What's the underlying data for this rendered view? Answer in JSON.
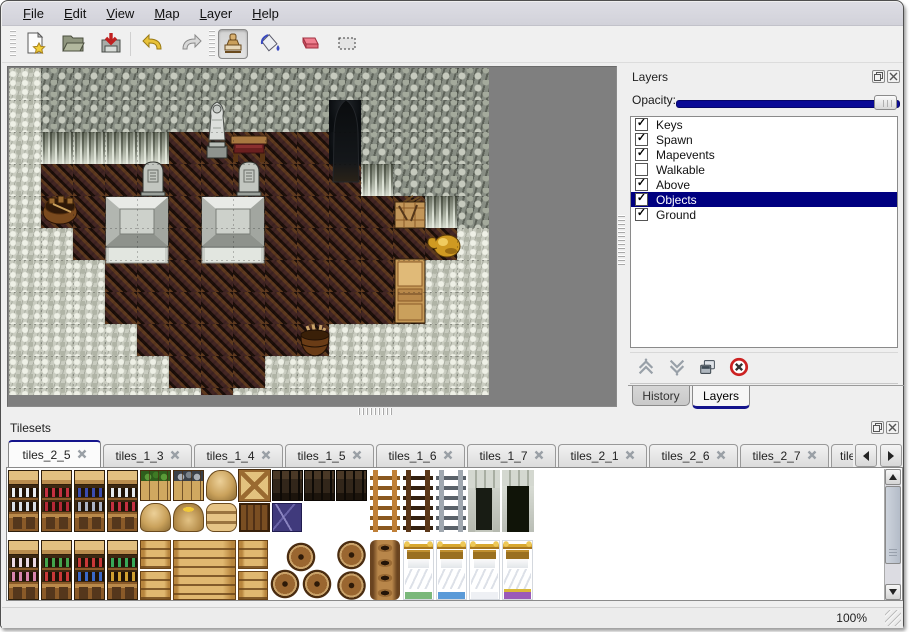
{
  "window": {
    "menu": [
      {
        "label": "File"
      },
      {
        "label": "Edit"
      },
      {
        "label": "View"
      },
      {
        "label": "Map"
      },
      {
        "label": "Layer"
      },
      {
        "label": "Help"
      }
    ],
    "toolbar": {
      "buttons": [
        {
          "icon": "new-file-icon"
        },
        {
          "icon": "open-icon"
        },
        {
          "icon": "save-icon"
        },
        {
          "icon": "undo-icon"
        },
        {
          "icon": "redo-icon"
        },
        {
          "icon": "stamp-tool-icon",
          "active": true
        },
        {
          "icon": "fill-tool-icon"
        },
        {
          "icon": "eraser-tool-icon"
        },
        {
          "icon": "select-tool-icon"
        }
      ]
    },
    "status": {
      "zoom_level": "100%"
    }
  },
  "map_view": {
    "tile_size": 32,
    "legend": {
      "W": "stone-wall",
      "C": "cliff-wall",
      "R": "stone-ground",
      "F": "wood-floor",
      "D": "cave-entrance"
    },
    "rows": [
      "RWWWWWWWWWWWWWW",
      "RWWWWWWWWWDWWWW",
      "RCCCCFFFFFDWWWW",
      "RFFFFFFFFFFCWWW",
      "RFFFFFFFFFFFFCW",
      "RRFFFFFFFFFFFFR",
      "RRRFFFFFFFFFFRR",
      "RRRFFFFFFFFFFRR",
      "RRRRFFFFFFRRRRR",
      "RRRRRFFFRRRRRRR",
      "RRRRRRFRRRRRRRR"
    ],
    "objects": [
      {
        "type": "statue",
        "x": 193,
        "y": 32,
        "w": 30,
        "h": 62
      },
      {
        "type": "table",
        "x": 221,
        "y": 64,
        "w": 38,
        "h": 32
      },
      {
        "type": "cave-door",
        "x": 318,
        "y": 30,
        "w": 38,
        "h": 86
      },
      {
        "type": "gravestone",
        "x": 130,
        "y": 90,
        "w": 28,
        "h": 38
      },
      {
        "type": "gravestone",
        "x": 226,
        "y": 90,
        "w": 28,
        "h": 38
      },
      {
        "type": "stone-platform",
        "x": 96,
        "y": 128,
        "w": 64,
        "h": 68
      },
      {
        "type": "stone-platform",
        "x": 192,
        "y": 128,
        "w": 64,
        "h": 68
      },
      {
        "type": "pot",
        "x": 32,
        "y": 118,
        "w": 38,
        "h": 40
      },
      {
        "type": "crate",
        "x": 384,
        "y": 126,
        "w": 34,
        "h": 36
      },
      {
        "type": "gold-vase",
        "x": 416,
        "y": 156,
        "w": 38,
        "h": 38
      },
      {
        "type": "cabinet",
        "x": 385,
        "y": 190,
        "w": 32,
        "h": 66
      },
      {
        "type": "barrel",
        "x": 288,
        "y": 252,
        "w": 36,
        "h": 38
      }
    ]
  },
  "layers_panel": {
    "title": "Layers",
    "window_buttons": [
      "float",
      "close"
    ],
    "opacity": {
      "label": "Opacity:",
      "value_percent": 100
    },
    "layers": [
      {
        "label": "Keys",
        "checked": true,
        "selected": false
      },
      {
        "label": "Spawn",
        "checked": true,
        "selected": false
      },
      {
        "label": "Mapevents",
        "checked": true,
        "selected": false
      },
      {
        "label": "Walkable",
        "checked": false,
        "selected": false
      },
      {
        "label": "Above",
        "checked": true,
        "selected": false
      },
      {
        "label": "Objects",
        "checked": true,
        "selected": true
      },
      {
        "label": "Ground",
        "checked": true,
        "selected": false
      }
    ],
    "actions": [
      "move-up",
      "move-down",
      "duplicate",
      "delete"
    ],
    "bottom_tabs": [
      {
        "label": "History",
        "active": false
      },
      {
        "label": "Layers",
        "active": true
      }
    ]
  },
  "tilesets_panel": {
    "title": "Tilesets",
    "window_buttons": [
      "float",
      "close"
    ],
    "tabs": [
      {
        "label": "tiles_2_5",
        "active": true
      },
      {
        "label": "tiles_1_3"
      },
      {
        "label": "tiles_1_4"
      },
      {
        "label": "tiles_1_5"
      },
      {
        "label": "tiles_1_6"
      },
      {
        "label": "tiles_1_7"
      },
      {
        "label": "tiles_2_1"
      },
      {
        "label": "tiles_2_6"
      },
      {
        "label": "tiles_2_7"
      },
      {
        "label": "tiles_",
        "truncated": true
      }
    ],
    "scroll_buttons": [
      "left",
      "right"
    ],
    "tiles": [
      {
        "t": "shelf-dishes",
        "x": 1,
        "y": 2,
        "w": 31,
        "h": 62
      },
      {
        "t": "shelf-red",
        "x": 34,
        "y": 2,
        "w": 31,
        "h": 62
      },
      {
        "t": "shelf-blue",
        "x": 67,
        "y": 2,
        "w": 31,
        "h": 62
      },
      {
        "t": "shelf-jars",
        "x": 100,
        "y": 2,
        "w": 31,
        "h": 62
      },
      {
        "t": "crate-green",
        "x": 133,
        "y": 2,
        "w": 31,
        "h": 31
      },
      {
        "t": "crate-gray",
        "x": 166,
        "y": 2,
        "w": 31,
        "h": 31
      },
      {
        "t": "sack",
        "x": 199,
        "y": 2,
        "w": 31,
        "h": 31
      },
      {
        "t": "crate-x",
        "x": 232,
        "y": 2,
        "w": 31,
        "h": 31
      },
      {
        "t": "chest-dark",
        "x": 265,
        "y": 2,
        "w": 31,
        "h": 31
      },
      {
        "t": "chest-dark",
        "x": 297,
        "y": 2,
        "w": 31,
        "h": 31
      },
      {
        "t": "chest-dark",
        "x": 329,
        "y": 2,
        "w": 31,
        "h": 31
      },
      {
        "t": "sack",
        "x": 133,
        "y": 35,
        "w": 31,
        "h": 29
      },
      {
        "t": "sack-open",
        "x": 166,
        "y": 35,
        "w": 31,
        "h": 29
      },
      {
        "t": "sack-stack",
        "x": 199,
        "y": 35,
        "w": 31,
        "h": 29
      },
      {
        "t": "crate-panel",
        "x": 232,
        "y": 35,
        "w": 31,
        "h": 29
      },
      {
        "t": "purple",
        "x": 265,
        "y": 35,
        "w": 30,
        "h": 29
      },
      {
        "t": "ladder-wood",
        "x": 363,
        "y": 2,
        "w": 30,
        "h": 62
      },
      {
        "t": "ladder-dark",
        "x": 396,
        "y": 2,
        "w": 30,
        "h": 62
      },
      {
        "t": "ladder-metal",
        "x": 429,
        "y": 2,
        "w": 30,
        "h": 62
      },
      {
        "t": "arch-open",
        "x": 461,
        "y": 2,
        "w": 32,
        "h": 62
      },
      {
        "t": "arch-door",
        "x": 495,
        "y": 2,
        "w": 32,
        "h": 62
      },
      {
        "t": "shelf-cakes",
        "x": 1,
        "y": 72,
        "w": 31,
        "h": 60
      },
      {
        "t": "shelf-potions",
        "x": 34,
        "y": 72,
        "w": 31,
        "h": 60
      },
      {
        "t": "shelf-books",
        "x": 67,
        "y": 72,
        "w": 31,
        "h": 60
      },
      {
        "t": "shelf-bottles",
        "x": 100,
        "y": 72,
        "w": 31,
        "h": 60
      },
      {
        "t": "crate-gold",
        "x": 133,
        "y": 72,
        "w": 31,
        "h": 29
      },
      {
        "t": "crate-gold-wide",
        "x": 166,
        "y": 72,
        "w": 63,
        "h": 60
      },
      {
        "t": "crate-gold",
        "x": 133,
        "y": 103,
        "w": 31,
        "h": 29
      },
      {
        "t": "crate-gold",
        "x": 231,
        "y": 72,
        "w": 30,
        "h": 29
      },
      {
        "t": "crate-gold",
        "x": 231,
        "y": 103,
        "w": 30,
        "h": 29
      },
      {
        "t": "barrel-pile",
        "x": 263,
        "y": 73,
        "w": 63,
        "h": 59
      },
      {
        "t": "barrel",
        "x": 329,
        "y": 72,
        "w": 31,
        "h": 30
      },
      {
        "t": "barrel",
        "x": 329,
        "y": 103,
        "w": 31,
        "h": 29
      },
      {
        "t": "pots",
        "x": 363,
        "y": 72,
        "w": 30,
        "h": 60
      },
      {
        "t": "bed-green",
        "x": 396,
        "y": 72,
        "w": 31,
        "h": 60
      },
      {
        "t": "bed-blue",
        "x": 429,
        "y": 72,
        "w": 31,
        "h": 60
      },
      {
        "t": "bed-plain",
        "x": 462,
        "y": 72,
        "w": 31,
        "h": 60
      },
      {
        "t": "bed-purple",
        "x": 495,
        "y": 72,
        "w": 31,
        "h": 60
      }
    ]
  },
  "colors": {
    "selection_navy": "#000080",
    "slider_fill": "#0a0a96",
    "tab_accent": "#14148c",
    "map_background": "#7f7f7f"
  }
}
